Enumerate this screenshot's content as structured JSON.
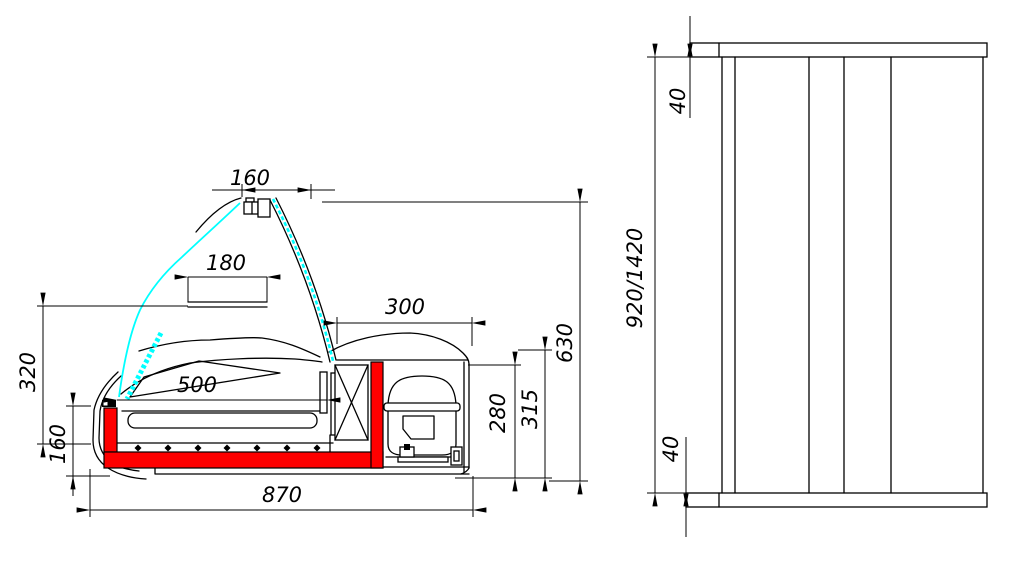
{
  "app": {
    "type": "cad-technical-drawing",
    "subject": "refrigerated-counter-display-case",
    "background": "#ffffff"
  },
  "colors": {
    "line": "#000000",
    "glass": "#00ffff",
    "insulation": "#fe0000"
  },
  "side_view": {
    "label": "side-section-view",
    "dims": {
      "lamp_width": "160",
      "canopy_box": "180",
      "deck_length": "500",
      "machine_width": "300",
      "glass_height": "320",
      "base_height": "160",
      "overall_depth": "870",
      "compartment_height": "280",
      "body_height": "315",
      "overall_height": "630"
    }
  },
  "front_view": {
    "label": "front-view",
    "dims": {
      "top_panel": "40",
      "bottom_panel": "40",
      "length_options": "920/1420"
    }
  }
}
